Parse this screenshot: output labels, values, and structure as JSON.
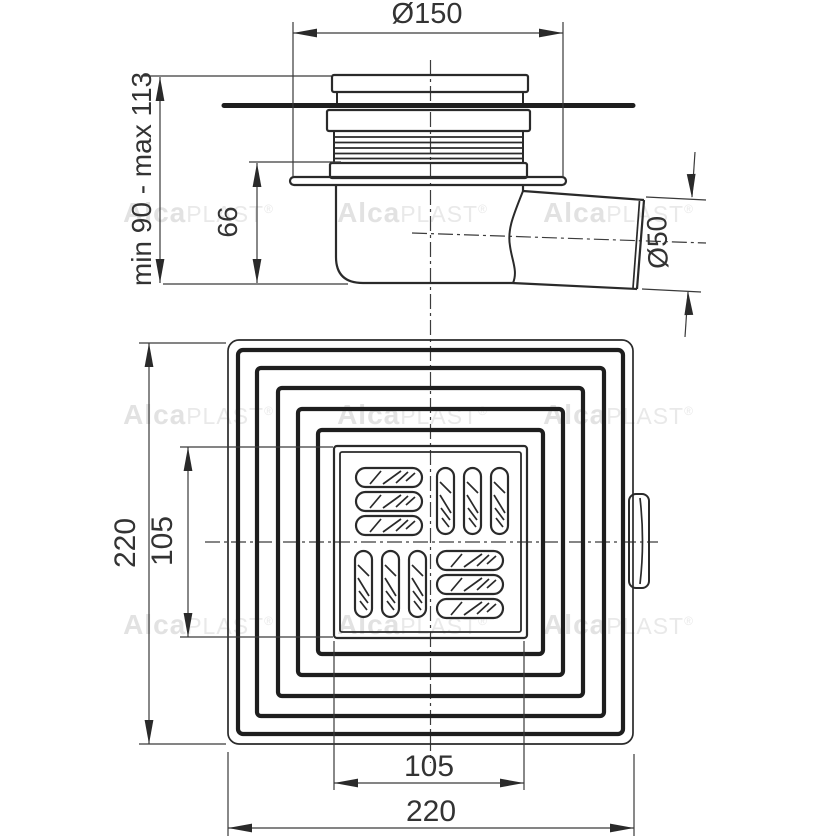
{
  "document": {
    "kind": "floor-drain technical drawing, two orthographic views",
    "side_view": {
      "dims": {
        "top_diameter": "Ø150",
        "install_height": "min 90 - max 113",
        "body_height": "66",
        "outlet_diameter": "Ø50"
      }
    },
    "plan_view": {
      "dims": {
        "overall_height": "220",
        "grate_height": "105",
        "grate_width": "105",
        "overall_width": "220"
      }
    },
    "watermark": {
      "bold": "Alca",
      "rest": "PLAST",
      "reg": "®"
    }
  },
  "colors": {
    "line": "#2a2a2a",
    "thick_line": "#1e1e1e",
    "dim_line": "#3a3a3a",
    "text": "#333333",
    "watermark": "#e6e6e6",
    "background": "#ffffff"
  }
}
